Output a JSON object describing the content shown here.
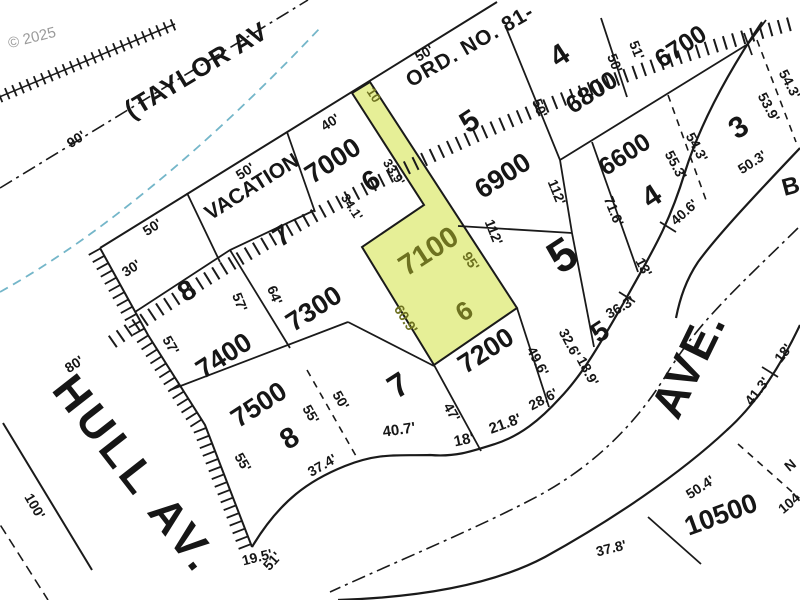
{
  "map_type": "assessor plat / tax lot map",
  "colors": {
    "ink": "#1a1a1a",
    "highlight_fill": "#e6ef97",
    "highlight_ink": "#6d7120",
    "water_blue": "#74b6c9",
    "copyright_gray": "#9a9a9a"
  },
  "highlighted_parcel": {
    "tax_lot": "7100",
    "lot_number": "6",
    "frontages": [
      "95'",
      "60.9'",
      "10"
    ]
  },
  "streets": [
    "(TAYLOR AV",
    "HULL AV.",
    "AVE.",
    "B"
  ],
  "annotations": [
    "VACATION",
    "ORD. NO. 81-",
    "© 2025"
  ],
  "tax_lots": [
    "6600",
    "6700",
    "6800",
    "6900",
    "7000",
    "7100",
    "7200",
    "7300",
    "7400",
    "7500",
    "10500"
  ],
  "lot_numbers": [
    "3",
    "4",
    "4",
    "5",
    "5",
    "5",
    "6",
    "6",
    "7",
    "7",
    "8",
    "8",
    "10"
  ],
  "labels": [
    {
      "n": "street-taylor-label",
      "t": "(TAYLOR AV",
      "x": 196,
      "y": 70,
      "r": -31,
      "s": 26,
      "ls": 1
    },
    {
      "n": "street-hull-label",
      "t": "HULL AV.",
      "x": 136,
      "y": 474,
      "r": 52,
      "s": 45,
      "ls": 5
    },
    {
      "n": "street-ave-label",
      "t": "AVE.",
      "x": 688,
      "y": 364,
      "r": -64,
      "s": 46,
      "ls": 2
    },
    {
      "n": "street-b-label",
      "t": "B",
      "x": 791,
      "y": 187,
      "r": -15,
      "s": 24
    },
    {
      "n": "vacation-label",
      "t": "VACATION",
      "x": 252,
      "y": 187,
      "r": -32,
      "s": 21
    },
    {
      "n": "ordinance-label",
      "t": "ORD. NO. 81-",
      "x": 470,
      "y": 46,
      "r": -30,
      "s": 21,
      "ls": 1
    },
    {
      "n": "copyright-label",
      "t": "© 2025",
      "x": 32,
      "y": 38,
      "r": -14,
      "s": 15,
      "c": "#9a9a9a",
      "w": 400
    },
    {
      "n": "taxlot-7000",
      "t": "7000",
      "x": 333,
      "y": 161,
      "r": -33,
      "s": 27
    },
    {
      "n": "taxlot-6900",
      "t": "6900",
      "x": 503,
      "y": 176,
      "r": -33,
      "s": 27
    },
    {
      "n": "taxlot-6800",
      "t": "6800",
      "x": 592,
      "y": 93,
      "r": -33,
      "s": 25
    },
    {
      "n": "taxlot-6700",
      "t": "6700",
      "x": 681,
      "y": 47,
      "r": -33,
      "s": 25
    },
    {
      "n": "taxlot-6600",
      "t": "6600",
      "x": 625,
      "y": 155,
      "r": -33,
      "s": 25
    },
    {
      "n": "taxlot-7100",
      "t": "7100",
      "x": 429,
      "y": 252,
      "r": -33,
      "s": 29,
      "c": "#6d7120"
    },
    {
      "n": "taxlot-7200",
      "t": "7200",
      "x": 486,
      "y": 351,
      "r": -33,
      "s": 27
    },
    {
      "n": "taxlot-7300",
      "t": "7300",
      "x": 314,
      "y": 309,
      "r": -33,
      "s": 27
    },
    {
      "n": "taxlot-7400",
      "t": "7400",
      "x": 224,
      "y": 356,
      "r": -33,
      "s": 27
    },
    {
      "n": "taxlot-7500",
      "t": "7500",
      "x": 259,
      "y": 405,
      "r": -33,
      "s": 27
    },
    {
      "n": "taxlot-10500",
      "t": "10500",
      "x": 721,
      "y": 515,
      "r": -20,
      "s": 27
    },
    {
      "n": "lot-8-upper",
      "t": "8",
      "x": 187,
      "y": 291,
      "r": -33,
      "s": 28
    },
    {
      "n": "lot-7-upper",
      "t": "7",
      "x": 282,
      "y": 236,
      "r": -33,
      "s": 28
    },
    {
      "n": "lot-6-upper",
      "t": "6",
      "x": 371,
      "y": 181,
      "r": -33,
      "s": 28
    },
    {
      "n": "lot-5-upper",
      "t": "5",
      "x": 470,
      "y": 122,
      "r": -33,
      "s": 30
    },
    {
      "n": "lot-4-6800",
      "t": "4",
      "x": 560,
      "y": 56,
      "r": -33,
      "s": 30
    },
    {
      "n": "lot-4-6600",
      "t": "4",
      "x": 652,
      "y": 197,
      "r": -33,
      "s": 30
    },
    {
      "n": "lot-3",
      "t": "3",
      "x": 739,
      "y": 128,
      "r": -33,
      "s": 30
    },
    {
      "n": "block-5-number",
      "t": "5",
      "x": 562,
      "y": 255,
      "r": -33,
      "s": 46
    },
    {
      "n": "lot-5-small",
      "t": "5",
      "x": 600,
      "y": 332,
      "r": -33,
      "s": 28
    },
    {
      "n": "lot-7-lower",
      "t": "7",
      "x": 398,
      "y": 385,
      "r": -33,
      "s": 33
    },
    {
      "n": "lot-8-lower",
      "t": "8",
      "x": 290,
      "y": 439,
      "r": -33,
      "s": 29
    },
    {
      "n": "lot-6-highlight",
      "t": "6",
      "x": 464,
      "y": 311,
      "r": -33,
      "s": 26,
      "c": "#6d7120"
    },
    {
      "n": "strip-10-label",
      "t": "10",
      "x": 374,
      "y": 95,
      "r": 57,
      "s": 13,
      "c": "#6d7120"
    },
    {
      "n": "dim-90",
      "t": "90'",
      "x": 76,
      "y": 139,
      "r": -33,
      "s": 14
    },
    {
      "n": "dim-50-lot8",
      "t": "50'",
      "x": 152,
      "y": 227,
      "r": -33,
      "s": 14
    },
    {
      "n": "dim-30",
      "t": "30'",
      "x": 131,
      "y": 268,
      "r": -33,
      "s": 14
    },
    {
      "n": "dim-50-vacation",
      "t": "50'",
      "x": 245,
      "y": 171,
      "r": -33,
      "s": 14
    },
    {
      "n": "dim-40",
      "t": "40'",
      "x": 330,
      "y": 122,
      "r": -33,
      "s": 14
    },
    {
      "n": "dim-50-top",
      "t": "50'",
      "x": 424,
      "y": 53,
      "r": -30,
      "s": 14
    },
    {
      "n": "dim-33-9",
      "t": "33.9'",
      "x": 394,
      "y": 172,
      "r": 57,
      "s": 13
    },
    {
      "n": "dim-34-1",
      "t": "34.1'",
      "x": 352,
      "y": 207,
      "r": 57,
      "s": 13
    },
    {
      "n": "dim-95",
      "t": "95'",
      "x": 471,
      "y": 261,
      "r": 57,
      "s": 14,
      "c": "#6d7120"
    },
    {
      "n": "dim-60-9",
      "t": "60.9'",
      "x": 406,
      "y": 319,
      "r": 57,
      "s": 14,
      "c": "#6d7120"
    },
    {
      "n": "dim-112-east",
      "t": "112'",
      "x": 557,
      "y": 192,
      "r": 68,
      "s": 14
    },
    {
      "n": "dim-112-west",
      "t": "112'",
      "x": 494,
      "y": 232,
      "r": 68,
      "s": 14
    },
    {
      "n": "dim-50-6800w",
      "t": "50'",
      "x": 540,
      "y": 108,
      "r": 68,
      "s": 14
    },
    {
      "n": "dim-50-6800e",
      "t": "50'",
      "x": 615,
      "y": 63,
      "r": 68,
      "s": 14
    },
    {
      "n": "dim-51",
      "t": "51'",
      "x": 637,
      "y": 50,
      "r": 68,
      "s": 14
    },
    {
      "n": "dim-71-6",
      "t": "71.6'",
      "x": 614,
      "y": 211,
      "r": 68,
      "s": 14
    },
    {
      "n": "dim-40-6",
      "t": "40.6'",
      "x": 684,
      "y": 212,
      "r": -42,
      "s": 14
    },
    {
      "n": "dim-54-3-a",
      "t": "54.3'",
      "x": 697,
      "y": 147,
      "r": 62,
      "s": 14
    },
    {
      "n": "dim-55-3",
      "t": "55.3'",
      "x": 676,
      "y": 165,
      "r": 62,
      "s": 14
    },
    {
      "n": "dim-53-9",
      "t": "53.9'",
      "x": 769,
      "y": 107,
      "r": 62,
      "s": 14
    },
    {
      "n": "dim-54-3-b",
      "t": "54.3'",
      "x": 790,
      "y": 84,
      "r": 62,
      "s": 14
    },
    {
      "n": "dim-50-3",
      "t": "50.3'",
      "x": 752,
      "y": 162,
      "r": -33,
      "s": 14
    },
    {
      "n": "dim-13",
      "t": "13'",
      "x": 644,
      "y": 267,
      "r": 62,
      "s": 14
    },
    {
      "n": "dim-36-3",
      "t": "36.3'",
      "x": 620,
      "y": 307,
      "r": -30,
      "s": 14
    },
    {
      "n": "dim-57-inner",
      "t": "57'",
      "x": 240,
      "y": 302,
      "r": 68,
      "s": 14
    },
    {
      "n": "dim-64",
      "t": "64'",
      "x": 275,
      "y": 295,
      "r": 68,
      "s": 14
    },
    {
      "n": "dim-57-hatch",
      "t": "57'",
      "x": 171,
      "y": 345,
      "r": 60,
      "s": 14
    },
    {
      "n": "dim-55-hatch",
      "t": "55'",
      "x": 243,
      "y": 462,
      "r": 60,
      "s": 14
    },
    {
      "n": "dim-80",
      "t": "80'",
      "x": 74,
      "y": 364,
      "r": -33,
      "s": 14
    },
    {
      "n": "dim-100",
      "t": "100'",
      "x": 35,
      "y": 506,
      "r": 60,
      "s": 14
    },
    {
      "n": "dim-55-7500",
      "t": "55'",
      "x": 311,
      "y": 414,
      "r": 60,
      "s": 14
    },
    {
      "n": "dim-50-lot7",
      "t": "50'",
      "x": 341,
      "y": 400,
      "r": 60,
      "s": 14
    },
    {
      "n": "dim-37-4",
      "t": "37.4'",
      "x": 322,
      "y": 465,
      "r": -30,
      "s": 14
    },
    {
      "n": "dim-40-7",
      "t": "40.7'",
      "x": 399,
      "y": 430,
      "r": -8,
      "s": 15
    },
    {
      "n": "dim-18-curve",
      "t": "18'",
      "x": 464,
      "y": 440,
      "r": -12,
      "s": 15
    },
    {
      "n": "dim-21-8",
      "t": "21.8'",
      "x": 505,
      "y": 424,
      "r": -20,
      "s": 15
    },
    {
      "n": "dim-28-6",
      "t": "28.6'",
      "x": 543,
      "y": 399,
      "r": -28,
      "s": 14
    },
    {
      "n": "dim-47",
      "t": "47'",
      "x": 452,
      "y": 412,
      "r": 60,
      "s": 14
    },
    {
      "n": "dim-49-6",
      "t": "49.6'",
      "x": 538,
      "y": 361,
      "r": 62,
      "s": 14
    },
    {
      "n": "dim-32-6",
      "t": "32.6'",
      "x": 570,
      "y": 343,
      "r": 62,
      "s": 14
    },
    {
      "n": "dim-18-9",
      "t": "18.9'",
      "x": 588,
      "y": 371,
      "r": 62,
      "s": 14
    },
    {
      "n": "dim-19-5",
      "t": "19.5'",
      "x": 257,
      "y": 557,
      "r": -14,
      "s": 14
    },
    {
      "n": "dim-51-overlap",
      "t": "51'",
      "x": 272,
      "y": 561,
      "r": -48,
      "s": 14
    },
    {
      "n": "dim-41-3",
      "t": "41.3'",
      "x": 757,
      "y": 391,
      "r": -52,
      "s": 14
    },
    {
      "n": "dim-18-ave",
      "t": "18'",
      "x": 783,
      "y": 353,
      "r": -52,
      "s": 14
    },
    {
      "n": "dim-50-4",
      "t": "50.4'",
      "x": 700,
      "y": 487,
      "r": -33,
      "s": 14
    },
    {
      "n": "dim-37-8",
      "t": "37.8'",
      "x": 611,
      "y": 548,
      "r": -14,
      "s": 14
    },
    {
      "n": "bearing-n-partial",
      "t": "N",
      "x": 790,
      "y": 465,
      "r": -40,
      "s": 14
    },
    {
      "n": "bearing-104-partial",
      "t": "104",
      "x": 789,
      "y": 503,
      "r": -40,
      "s": 14
    }
  ]
}
